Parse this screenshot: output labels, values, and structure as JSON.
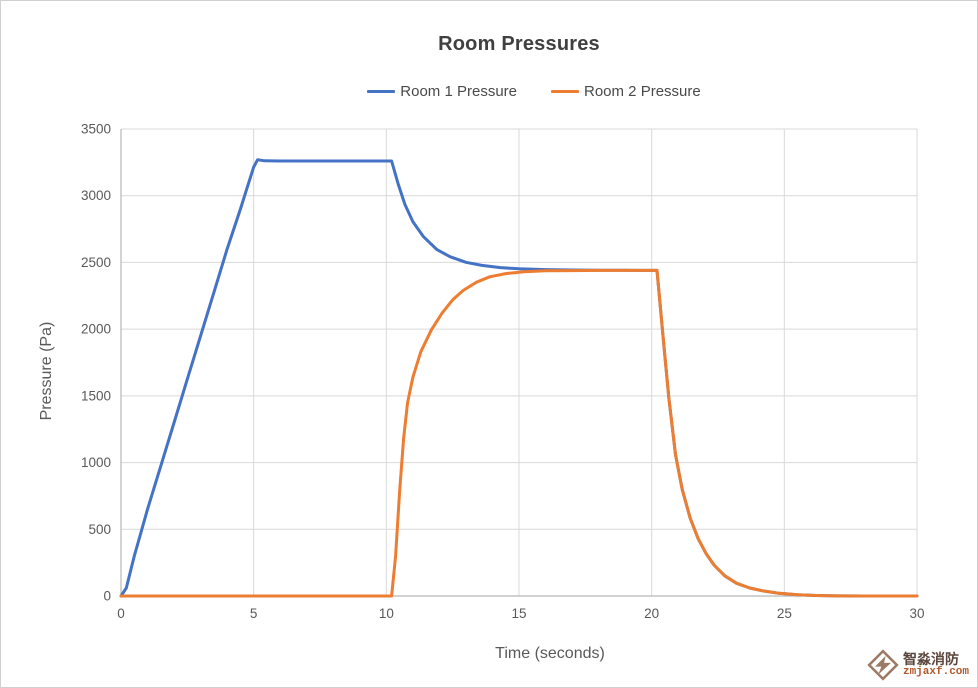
{
  "window": {
    "background": "#ffffff",
    "border_color": "#d0d0d0"
  },
  "axes_style": {
    "tick_label_color": "#595959",
    "grid_color": "#d9d9d9",
    "axis_line_color": "#b7b7b7"
  },
  "watermark": {
    "logo_icon": "zmjaxf-diamond-logo",
    "logo_color": "#9c7a66",
    "company_cn": "智淼消防",
    "domain": "zmjaxf.com"
  },
  "chart_data": {
    "type": "line",
    "title": "Room Pressures",
    "xlabel": "Time (seconds)",
    "ylabel": "Pressure (Pa)",
    "xlim": [
      0,
      30
    ],
    "ylim": [
      0,
      3500
    ],
    "xticks": [
      0,
      5,
      10,
      15,
      20,
      25,
      30
    ],
    "yticks": [
      0,
      500,
      1000,
      1500,
      2000,
      2500,
      3000,
      3500
    ],
    "grid": true,
    "legend_position": "top-center",
    "series": [
      {
        "name": "Room 1 Pressure",
        "color": "#4472C4",
        "points": [
          [
            0,
            0
          ],
          [
            0.2,
            60
          ],
          [
            0.5,
            300
          ],
          [
            1,
            650
          ],
          [
            1.5,
            975
          ],
          [
            2,
            1300
          ],
          [
            2.5,
            1625
          ],
          [
            3,
            1950
          ],
          [
            3.5,
            2275
          ],
          [
            4,
            2600
          ],
          [
            4.5,
            2900
          ],
          [
            4.8,
            3090
          ],
          [
            5.0,
            3215
          ],
          [
            5.15,
            3270
          ],
          [
            5.4,
            3262
          ],
          [
            6,
            3260
          ],
          [
            8,
            3260
          ],
          [
            10.2,
            3260
          ],
          [
            10.45,
            3085
          ],
          [
            10.7,
            2935
          ],
          [
            11.0,
            2805
          ],
          [
            11.4,
            2693
          ],
          [
            11.9,
            2598
          ],
          [
            12.4,
            2543
          ],
          [
            13.0,
            2501
          ],
          [
            13.6,
            2478
          ],
          [
            14.3,
            2461
          ],
          [
            15.0,
            2452
          ],
          [
            16.0,
            2446
          ],
          [
            17.0,
            2443
          ],
          [
            18.0,
            2442
          ],
          [
            19.0,
            2441
          ],
          [
            20.2,
            2440
          ],
          [
            20.45,
            1900
          ],
          [
            20.65,
            1480
          ],
          [
            20.9,
            1060
          ],
          [
            21.15,
            800
          ],
          [
            21.45,
            585
          ],
          [
            21.75,
            430
          ],
          [
            22.05,
            318
          ],
          [
            22.35,
            232
          ],
          [
            22.75,
            152
          ],
          [
            23.2,
            95
          ],
          [
            23.7,
            60
          ],
          [
            24.2,
            38
          ],
          [
            24.8,
            20
          ],
          [
            25.5,
            9
          ],
          [
            26.2,
            4
          ],
          [
            27,
            1
          ],
          [
            28,
            0
          ],
          [
            30,
            0
          ]
        ]
      },
      {
        "name": "Room 2 Pressure",
        "color": "#ED7D31",
        "points": [
          [
            0,
            0
          ],
          [
            10.2,
            0
          ],
          [
            10.35,
            300
          ],
          [
            10.5,
            780
          ],
          [
            10.65,
            1180
          ],
          [
            10.8,
            1450
          ],
          [
            11.0,
            1640
          ],
          [
            11.3,
            1830
          ],
          [
            11.7,
            1995
          ],
          [
            12.1,
            2120
          ],
          [
            12.5,
            2220
          ],
          [
            12.9,
            2290
          ],
          [
            13.4,
            2352
          ],
          [
            13.9,
            2392
          ],
          [
            14.5,
            2416
          ],
          [
            15.2,
            2430
          ],
          [
            16.0,
            2437
          ],
          [
            17.0,
            2439
          ],
          [
            18.0,
            2440
          ],
          [
            19.0,
            2440
          ],
          [
            20.2,
            2440
          ],
          [
            20.45,
            1900
          ],
          [
            20.65,
            1480
          ],
          [
            20.9,
            1060
          ],
          [
            21.15,
            800
          ],
          [
            21.45,
            585
          ],
          [
            21.75,
            430
          ],
          [
            22.05,
            318
          ],
          [
            22.35,
            232
          ],
          [
            22.75,
            152
          ],
          [
            23.2,
            95
          ],
          [
            23.7,
            60
          ],
          [
            24.2,
            38
          ],
          [
            24.8,
            20
          ],
          [
            25.5,
            9
          ],
          [
            26.2,
            4
          ],
          [
            27,
            1
          ],
          [
            28,
            0
          ],
          [
            30,
            0
          ]
        ]
      }
    ]
  }
}
